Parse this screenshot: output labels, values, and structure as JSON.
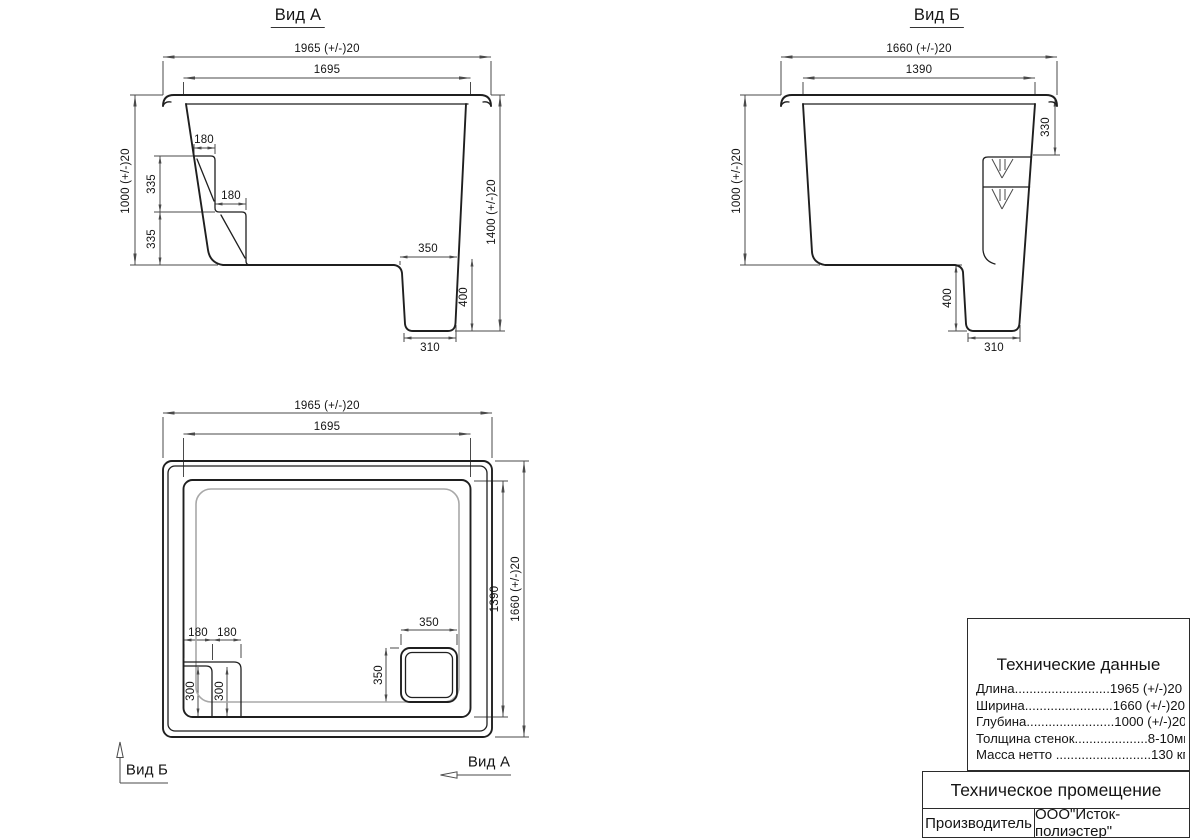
{
  "colors": {
    "line": "#1f1f1f",
    "dim": "#4a4a4a",
    "floor": "#a8a8a8",
    "text": "#141414"
  },
  "view_a": {
    "title": "Вид А",
    "dim_width_outer": "1965 (+/-)20",
    "dim_width_inner": "1695",
    "dim_depth_left": "1000 (+/-)20",
    "dim_depth_right": "1400 (+/-)20",
    "dim_step_width_1": "180",
    "dim_step_width_2": "180",
    "dim_step_rise_1": "335",
    "dim_step_rise_2": "335",
    "dim_sump_top": "350",
    "dim_sump_depth": "400",
    "dim_sump_bottom": "310"
  },
  "view_b": {
    "title": "Вид Б",
    "dim_width_outer": "1660 (+/-)20",
    "dim_width_inner": "1390",
    "dim_depth_left": "1000 (+/-)20",
    "dim_step_depth": "330",
    "dim_sump_depth": "400",
    "dim_sump_bottom": "310"
  },
  "top_view": {
    "dim_length_outer": "1965 (+/-)20",
    "dim_length_inner": "1695",
    "dim_width_inner": "1390",
    "dim_width_outer": "1660 (+/-)20",
    "dim_step_width_1": "180",
    "dim_step_width_2": "180",
    "dim_step_len_1": "300",
    "dim_step_len_2": "300",
    "dim_sump_width": "350",
    "dim_sump_length": "350",
    "view_b_arrow_label": "Вид Б",
    "view_a_arrow_label": "Вид А"
  },
  "tech_table": {
    "title": "Технические данные",
    "rows": [
      "Длина..........................1965 (+/-)20",
      "Ширина........................1660 (+/-)20",
      "Глубина........................1000 (+/-)20",
      "Толщина стенок....................8-10мм",
      "Масса нетто ..........................130 кг"
    ],
    "product_name": "Техническое промещение",
    "manufacturer_label": "Производитель",
    "manufacturer_value": "ООО\"Исток-полиэстер\""
  }
}
